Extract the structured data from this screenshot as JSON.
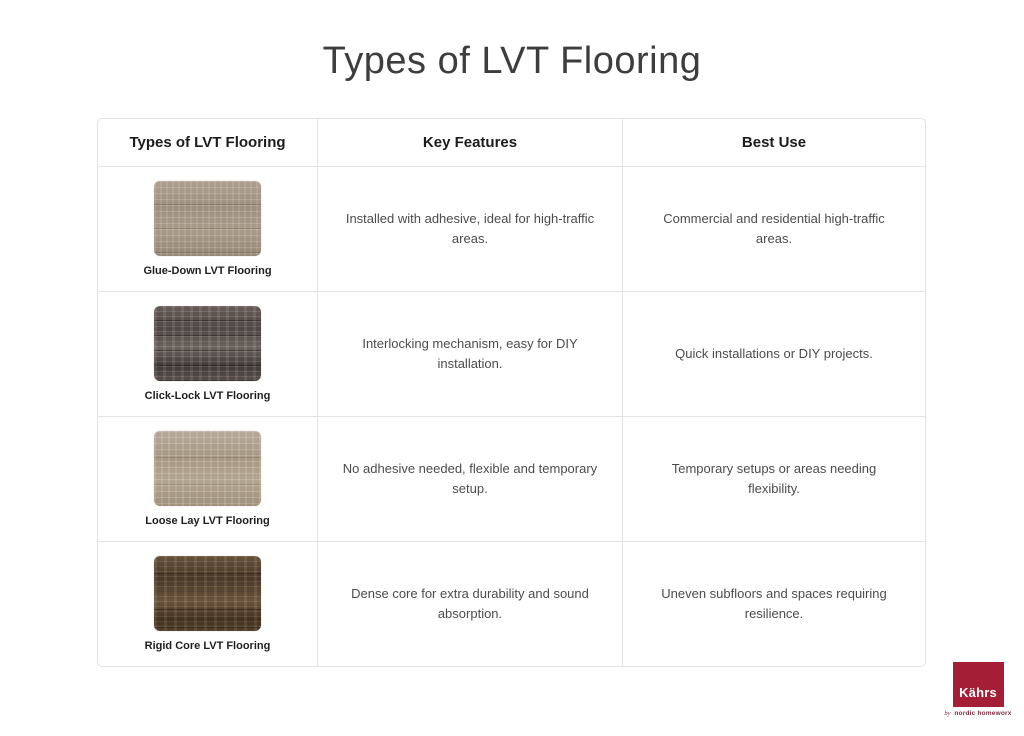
{
  "page": {
    "title": "Types of LVT Flooring"
  },
  "table": {
    "headers": [
      "Types of LVT Flooring",
      "Key Features",
      "Best Use"
    ],
    "rows": [
      {
        "type_label": "Glue-Down LVT Flooring",
        "image": "glue-down-wood-swatch",
        "features": "Installed with adhesive, ideal for high-traffic areas.",
        "best_use": "Commercial and residential high-traffic areas."
      },
      {
        "type_label": "Click-Lock LVT Flooring",
        "image": "click-lock-wood-swatch",
        "features": "Interlocking mechanism, easy for DIY installation.",
        "best_use": "Quick installations or DIY projects."
      },
      {
        "type_label": "Loose Lay LVT Flooring",
        "image": "loose-lay-wood-swatch",
        "features": "No adhesive needed, flexible and temporary setup.",
        "best_use": "Temporary setups or areas needing flexibility."
      },
      {
        "type_label": "Rigid Core LVT Flooring",
        "image": "rigid-core-wood-swatch",
        "features": "Dense core for extra durability and sound absorption.",
        "best_use": "Uneven subfloors and spaces requiring resilience."
      }
    ]
  },
  "logo": {
    "brand": "Kährs",
    "tagline_by": "by",
    "tagline_name": "nordic homeworx",
    "brand_color": "#a41e35",
    "tagline_color": "#7e2c3d"
  },
  "colors": {
    "table_border": "#e3e3e3",
    "title_text": "#3d3d3d",
    "header_text": "#1c1c1c",
    "body_text": "#4c4c4c",
    "wood_glue_down": "#a79a89",
    "wood_click_lock": "#5b524d",
    "wood_loose_lay": "#b2a28d",
    "wood_rigid_core": "#5e4a36"
  }
}
